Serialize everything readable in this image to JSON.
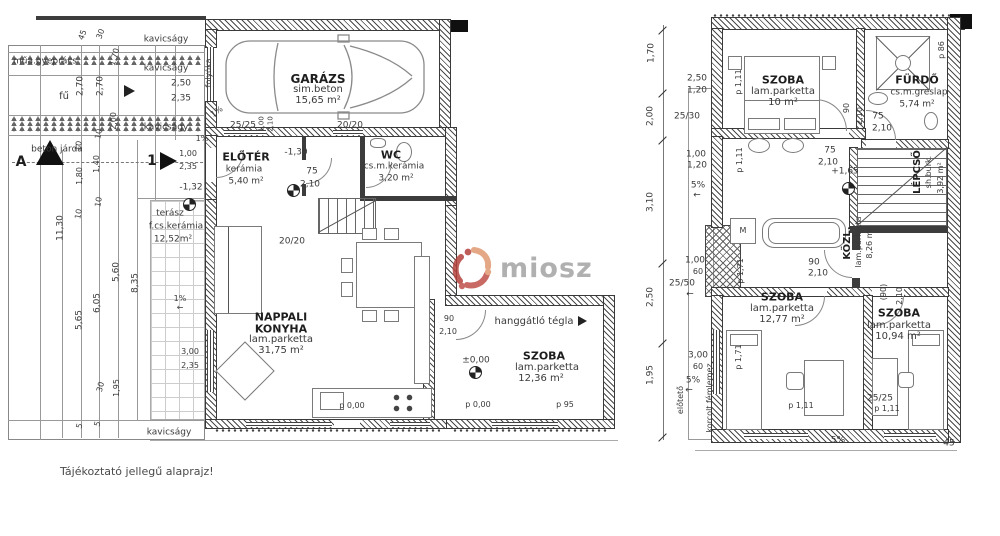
{
  "note": "Tájékoztató jellegű alaprajz!",
  "watermark": {
    "text": "miosz"
  },
  "colors": {
    "line": "#555555",
    "text": "#333333",
    "logo_red": "#b5413c",
    "logo_dark_red": "#c0504a",
    "logo_salmon": "#e09a72",
    "logo_text_gray": "#a3a3a3"
  },
  "left_plan": {
    "labels": [
      {
        "t": "kavicságy",
        "x": 166,
        "y": 40
      },
      {
        "t": "műa.gyeprács",
        "x": 45,
        "y": 62
      },
      {
        "t": "kavicságy",
        "x": 166,
        "y": 69
      },
      {
        "t": "2,50",
        "x": 181,
        "y": 84
      },
      {
        "t": "2,35",
        "x": 181,
        "y": 99
      },
      {
        "t": "fű",
        "x": 64,
        "y": 97,
        "fs": 10
      },
      {
        "t": "2,70",
        "x": 81,
        "y": 86,
        "r": -90
      },
      {
        "t": "2,70",
        "x": 101,
        "y": 86,
        "r": -90
      },
      {
        "t": "1,70",
        "x": 115,
        "y": 57,
        "r": -75,
        "fs": 8
      },
      {
        "t": "45",
        "x": 83,
        "y": 35,
        "r": -70,
        "fs": 8
      },
      {
        "t": "30",
        "x": 101,
        "y": 34,
        "r": -70,
        "fs": 8
      },
      {
        "t": "kavicságy",
        "x": 166,
        "y": 128
      },
      {
        "t": "1%",
        "x": 217,
        "y": 112,
        "r": -35,
        "fs": 8
      },
      {
        "t": "1%",
        "x": 202,
        "y": 139,
        "fs": 8
      },
      {
        "t": "beton járda",
        "x": 57,
        "y": 150
      },
      {
        "t": "A",
        "x": 21,
        "y": 162,
        "fs": 14,
        "b": true,
        "n": "section-marker-a"
      },
      {
        "t": "1",
        "x": 152,
        "y": 161,
        "fs": 14,
        "b": true,
        "n": "section-marker-1"
      },
      {
        "t": "1,00",
        "x": 188,
        "y": 154,
        "fs": 8
      },
      {
        "t": "2,35",
        "x": 188,
        "y": 167,
        "fs": 8
      },
      {
        "t": "-1,32",
        "x": 191,
        "y": 188
      },
      {
        "t": "terász",
        "x": 170,
        "y": 214,
        "n": "room-terasz"
      },
      {
        "t": "f.cs.kerámia",
        "x": 176,
        "y": 227
      },
      {
        "t": "12,52m²",
        "x": 173,
        "y": 240
      },
      {
        "t": "11,30",
        "x": 61,
        "y": 228,
        "r": -90
      },
      {
        "t": "10",
        "x": 79,
        "y": 146,
        "r": -80,
        "fs": 8
      },
      {
        "t": "10",
        "x": 99,
        "y": 134,
        "r": -80,
        "fs": 8
      },
      {
        "t": "1,40",
        "x": 97,
        "y": 164,
        "r": -90,
        "fs": 8
      },
      {
        "t": "1,80",
        "x": 80,
        "y": 176,
        "r": -90,
        "fs": 8
      },
      {
        "t": "10",
        "x": 99,
        "y": 202,
        "r": -80,
        "fs": 8
      },
      {
        "t": "10",
        "x": 79,
        "y": 214,
        "r": -80,
        "fs": 8
      },
      {
        "t": "2,00",
        "x": 114,
        "y": 121,
        "r": -90,
        "fs": 8
      },
      {
        "t": "5,65",
        "x": 80,
        "y": 320,
        "r": -90
      },
      {
        "t": "6,05",
        "x": 98,
        "y": 303,
        "r": -90
      },
      {
        "t": "5,60",
        "x": 117,
        "y": 272,
        "r": -90
      },
      {
        "t": "8,35",
        "x": 136,
        "y": 283,
        "r": -90
      },
      {
        "t": "1%",
        "x": 180,
        "y": 299,
        "fs": 8
      },
      {
        "t": "←",
        "x": 180,
        "y": 308,
        "fs": 8
      },
      {
        "t": "3,00",
        "x": 190,
        "y": 352,
        "fs": 8
      },
      {
        "t": "2,35",
        "x": 190,
        "y": 366,
        "fs": 8
      },
      {
        "t": "1,95",
        "x": 117,
        "y": 388,
        "r": -90,
        "fs": 8
      },
      {
        "t": "30",
        "x": 101,
        "y": 387,
        "r": -75,
        "fs": 8
      },
      {
        "t": "5",
        "x": 80,
        "y": 426,
        "r": -75,
        "fs": 8
      },
      {
        "t": "5",
        "x": 98,
        "y": 424,
        "r": -75,
        "fs": 8
      },
      {
        "t": "kavicságy",
        "x": 169,
        "y": 433
      },
      {
        "t": "folyóka",
        "x": 209,
        "y": 73,
        "r": -90,
        "fs": 8
      },
      {
        "t": "GARÁZS",
        "x": 318,
        "y": 79,
        "fs": 12,
        "b": true,
        "n": "room-garazs"
      },
      {
        "t": "sim.beton",
        "x": 318,
        "y": 90,
        "fs": 10
      },
      {
        "t": "15,65 m²",
        "x": 318,
        "y": 101,
        "fs": 10
      },
      {
        "t": "25/25",
        "x": 243,
        "y": 126
      },
      {
        "t": "1,00",
        "x": 262,
        "y": 124,
        "r": -90,
        "fs": 7
      },
      {
        "t": "2,10",
        "x": 271,
        "y": 124,
        "r": -90,
        "fs": 7
      },
      {
        "t": "20/20",
        "x": 350,
        "y": 126
      },
      {
        "t": "ELŐTÉR",
        "x": 246,
        "y": 157,
        "fs": 11,
        "b": true,
        "n": "room-eloter"
      },
      {
        "t": "kerámia",
        "x": 244,
        "y": 170
      },
      {
        "t": "5,40 m²",
        "x": 246,
        "y": 182
      },
      {
        "t": "-1,30",
        "x": 296,
        "y": 153
      },
      {
        "t": "75",
        "x": 312,
        "y": 172
      },
      {
        "t": "2,10",
        "x": 310,
        "y": 185
      },
      {
        "t": "WC",
        "x": 391,
        "y": 155,
        "fs": 11,
        "b": true,
        "n": "room-wc"
      },
      {
        "t": "cs.m.kerámia",
        "x": 394,
        "y": 167
      },
      {
        "t": "3,20 m²",
        "x": 396,
        "y": 179
      },
      {
        "t": "20/20",
        "x": 292,
        "y": 242
      },
      {
        "t": "NAPPALI",
        "x": 281,
        "y": 317,
        "fs": 11,
        "b": true,
        "n": "room-nappali-konyha"
      },
      {
        "t": "KONYHA",
        "x": 281,
        "y": 329,
        "fs": 11,
        "b": true
      },
      {
        "t": "lam.parketta",
        "x": 281,
        "y": 340,
        "fs": 10
      },
      {
        "t": "31,75 m²",
        "x": 281,
        "y": 351,
        "fs": 10
      },
      {
        "t": "p 0,00",
        "x": 352,
        "y": 406,
        "fs": 8
      },
      {
        "t": "90",
        "x": 449,
        "y": 319,
        "fs": 8
      },
      {
        "t": "2,10",
        "x": 448,
        "y": 332,
        "fs": 8
      },
      {
        "t": "hanggátló tégla",
        "x": 534,
        "y": 322,
        "fs": 10,
        "n": "note-hanggatlo-tegla"
      },
      {
        "t": "±0,00",
        "x": 476,
        "y": 361
      },
      {
        "t": "SZOBA",
        "x": 544,
        "y": 356,
        "fs": 11,
        "b": true,
        "n": "room-szoba-fsz"
      },
      {
        "t": "lam.parketta",
        "x": 547,
        "y": 368,
        "fs": 10
      },
      {
        "t": "12,36 m²",
        "x": 541,
        "y": 379,
        "fs": 10
      },
      {
        "t": "p 0,00",
        "x": 478,
        "y": 405,
        "fs": 8
      },
      {
        "t": "p 95",
        "x": 565,
        "y": 405,
        "fs": 8
      }
    ]
  },
  "right_plan": {
    "labels": [
      {
        "t": "1,70",
        "x": 652,
        "y": 53,
        "r": -90
      },
      {
        "t": "2,50",
        "x": 697,
        "y": 79
      },
      {
        "t": "1,20",
        "x": 697,
        "y": 91
      },
      {
        "t": "25/30",
        "x": 687,
        "y": 117
      },
      {
        "t": "2,00",
        "x": 651,
        "y": 116,
        "r": -90
      },
      {
        "t": "1,00",
        "x": 696,
        "y": 155
      },
      {
        "t": "1,20",
        "x": 697,
        "y": 166
      },
      {
        "t": "5%",
        "x": 698,
        "y": 186
      },
      {
        "t": "←",
        "x": 697,
        "y": 196
      },
      {
        "t": "3,10",
        "x": 651,
        "y": 202,
        "r": -90
      },
      {
        "t": "1,00",
        "x": 695,
        "y": 261
      },
      {
        "t": "60",
        "x": 698,
        "y": 272,
        "fs": 8
      },
      {
        "t": "25/50",
        "x": 682,
        "y": 284
      },
      {
        "t": "←",
        "x": 690,
        "y": 295
      },
      {
        "t": "2,50",
        "x": 651,
        "y": 297,
        "r": -90
      },
      {
        "t": "3,00",
        "x": 698,
        "y": 356
      },
      {
        "t": "60",
        "x": 698,
        "y": 367,
        "fs": 8
      },
      {
        "t": "5%",
        "x": 693,
        "y": 381
      },
      {
        "t": "←",
        "x": 689,
        "y": 391
      },
      {
        "t": "1,95",
        "x": 651,
        "y": 375,
        "r": -90
      },
      {
        "t": "előtető",
        "x": 681,
        "y": 400,
        "r": -90,
        "fs": 8
      },
      {
        "t": "korcolt fémlemez",
        "x": 710,
        "y": 398,
        "r": -90,
        "fs": 8
      },
      {
        "t": "SZOBA",
        "x": 783,
        "y": 80,
        "fs": 11,
        "b": true,
        "n": "room-szoba-10"
      },
      {
        "t": "lam.parketta",
        "x": 783,
        "y": 92,
        "fs": 10
      },
      {
        "t": "10 m²",
        "x": 783,
        "y": 103,
        "fs": 10
      },
      {
        "t": "p 1,11",
        "x": 739,
        "y": 82,
        "r": -90,
        "fs": 8
      },
      {
        "t": "FÜRDŐ",
        "x": 917,
        "y": 80,
        "fs": 11,
        "b": true,
        "n": "room-furdo"
      },
      {
        "t": "cs.m.greslap",
        "x": 919,
        "y": 93
      },
      {
        "t": "5,74 m²",
        "x": 917,
        "y": 105
      },
      {
        "t": "p 86",
        "x": 942,
        "y": 50,
        "r": -90,
        "fs": 8
      },
      {
        "t": "90",
        "x": 847,
        "y": 108,
        "r": -90,
        "fs": 8
      },
      {
        "t": "2,10",
        "x": 860,
        "y": 116,
        "r": -90,
        "fs": 8
      },
      {
        "t": "75",
        "x": 878,
        "y": 117
      },
      {
        "t": "2,10",
        "x": 882,
        "y": 129
      },
      {
        "t": "75",
        "x": 830,
        "y": 151
      },
      {
        "t": "2,10",
        "x": 828,
        "y": 163
      },
      {
        "t": "+1,65",
        "x": 845,
        "y": 172
      },
      {
        "t": "LÉPCSŐ",
        "x": 918,
        "y": 172,
        "r": -90,
        "fs": 10,
        "b": true,
        "n": "room-lepcso"
      },
      {
        "t": "sh.burk.",
        "x": 929,
        "y": 172,
        "r": -90,
        "fs": 8
      },
      {
        "t": "3,92 m²",
        "x": 941,
        "y": 178,
        "r": -90,
        "fs": 8
      },
      {
        "t": "KÖZL.",
        "x": 848,
        "y": 243,
        "r": -90,
        "fs": 10,
        "b": true,
        "n": "room-kozl"
      },
      {
        "t": "lam.parketta",
        "x": 859,
        "y": 242,
        "r": -90,
        "fs": 8
      },
      {
        "t": "8,26 m²",
        "x": 870,
        "y": 243,
        "r": -90,
        "fs": 8
      },
      {
        "t": "M",
        "x": 743,
        "y": 231,
        "fs": 8
      },
      {
        "t": "p 1,11",
        "x": 740,
        "y": 160,
        "r": -90,
        "fs": 8
      },
      {
        "t": "p 1,71",
        "x": 741,
        "y": 271,
        "r": -90,
        "fs": 8
      },
      {
        "t": "90",
        "x": 814,
        "y": 263
      },
      {
        "t": "2,10",
        "x": 818,
        "y": 274
      },
      {
        "t": "(90)",
        "x": 884,
        "y": 292,
        "r": -90,
        "fs": 8
      },
      {
        "t": "2,10",
        "x": 900,
        "y": 296,
        "r": -90,
        "fs": 8
      },
      {
        "t": "SZOBA",
        "x": 782,
        "y": 297,
        "fs": 11,
        "b": true,
        "n": "room-szoba-1277"
      },
      {
        "t": "lam.parketta",
        "x": 782,
        "y": 309,
        "fs": 10
      },
      {
        "t": "12,77 m²",
        "x": 782,
        "y": 320,
        "fs": 10
      },
      {
        "t": "SZOBA",
        "x": 899,
        "y": 313,
        "fs": 11,
        "b": true,
        "n": "room-szoba-1094"
      },
      {
        "t": "lam.parketta",
        "x": 899,
        "y": 326,
        "fs": 10
      },
      {
        "t": "10,94 m²",
        "x": 898,
        "y": 337,
        "fs": 10
      },
      {
        "t": "p 1,71",
        "x": 739,
        "y": 357,
        "r": -90,
        "fs": 8
      },
      {
        "t": "p 1,11",
        "x": 801,
        "y": 406,
        "fs": 8
      },
      {
        "t": "25/25",
        "x": 880,
        "y": 399
      },
      {
        "t": "p 1,11",
        "x": 887,
        "y": 409,
        "fs": 8
      },
      {
        "t": "5%",
        "x": 838,
        "y": 441
      },
      {
        "t": "45",
        "x": 949,
        "y": 444
      }
    ]
  }
}
